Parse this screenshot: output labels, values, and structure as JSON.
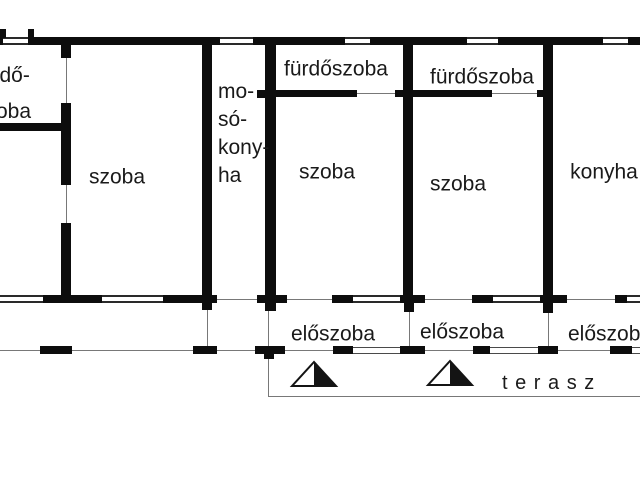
{
  "floor_plan": {
    "labels": {
      "bathroom_top_left": {
        "lines": [
          "fürdő-",
          "szoba"
        ]
      },
      "room_1": "szoba",
      "laundry_kitchen": {
        "lines": [
          "mo-",
          "só-",
          "kony-",
          "ha"
        ]
      },
      "bathroom_1": "fürdőszoba",
      "bathroom_2": "fürdőszoba",
      "room_2": "szoba",
      "room_3": "szoba",
      "kitchen": "konyha",
      "hallway_1": "előszoba",
      "hallway_2": "előszoba",
      "hallway_3": "előszoba",
      "terrace": "t e r a s z"
    },
    "symbols": [
      "stairs-triangle",
      "stairs-triangle"
    ],
    "colors": {
      "wall": "#0d0d0d",
      "thin_line": "#787878",
      "text": "#1a1a1a",
      "background": "#ffffff"
    }
  }
}
